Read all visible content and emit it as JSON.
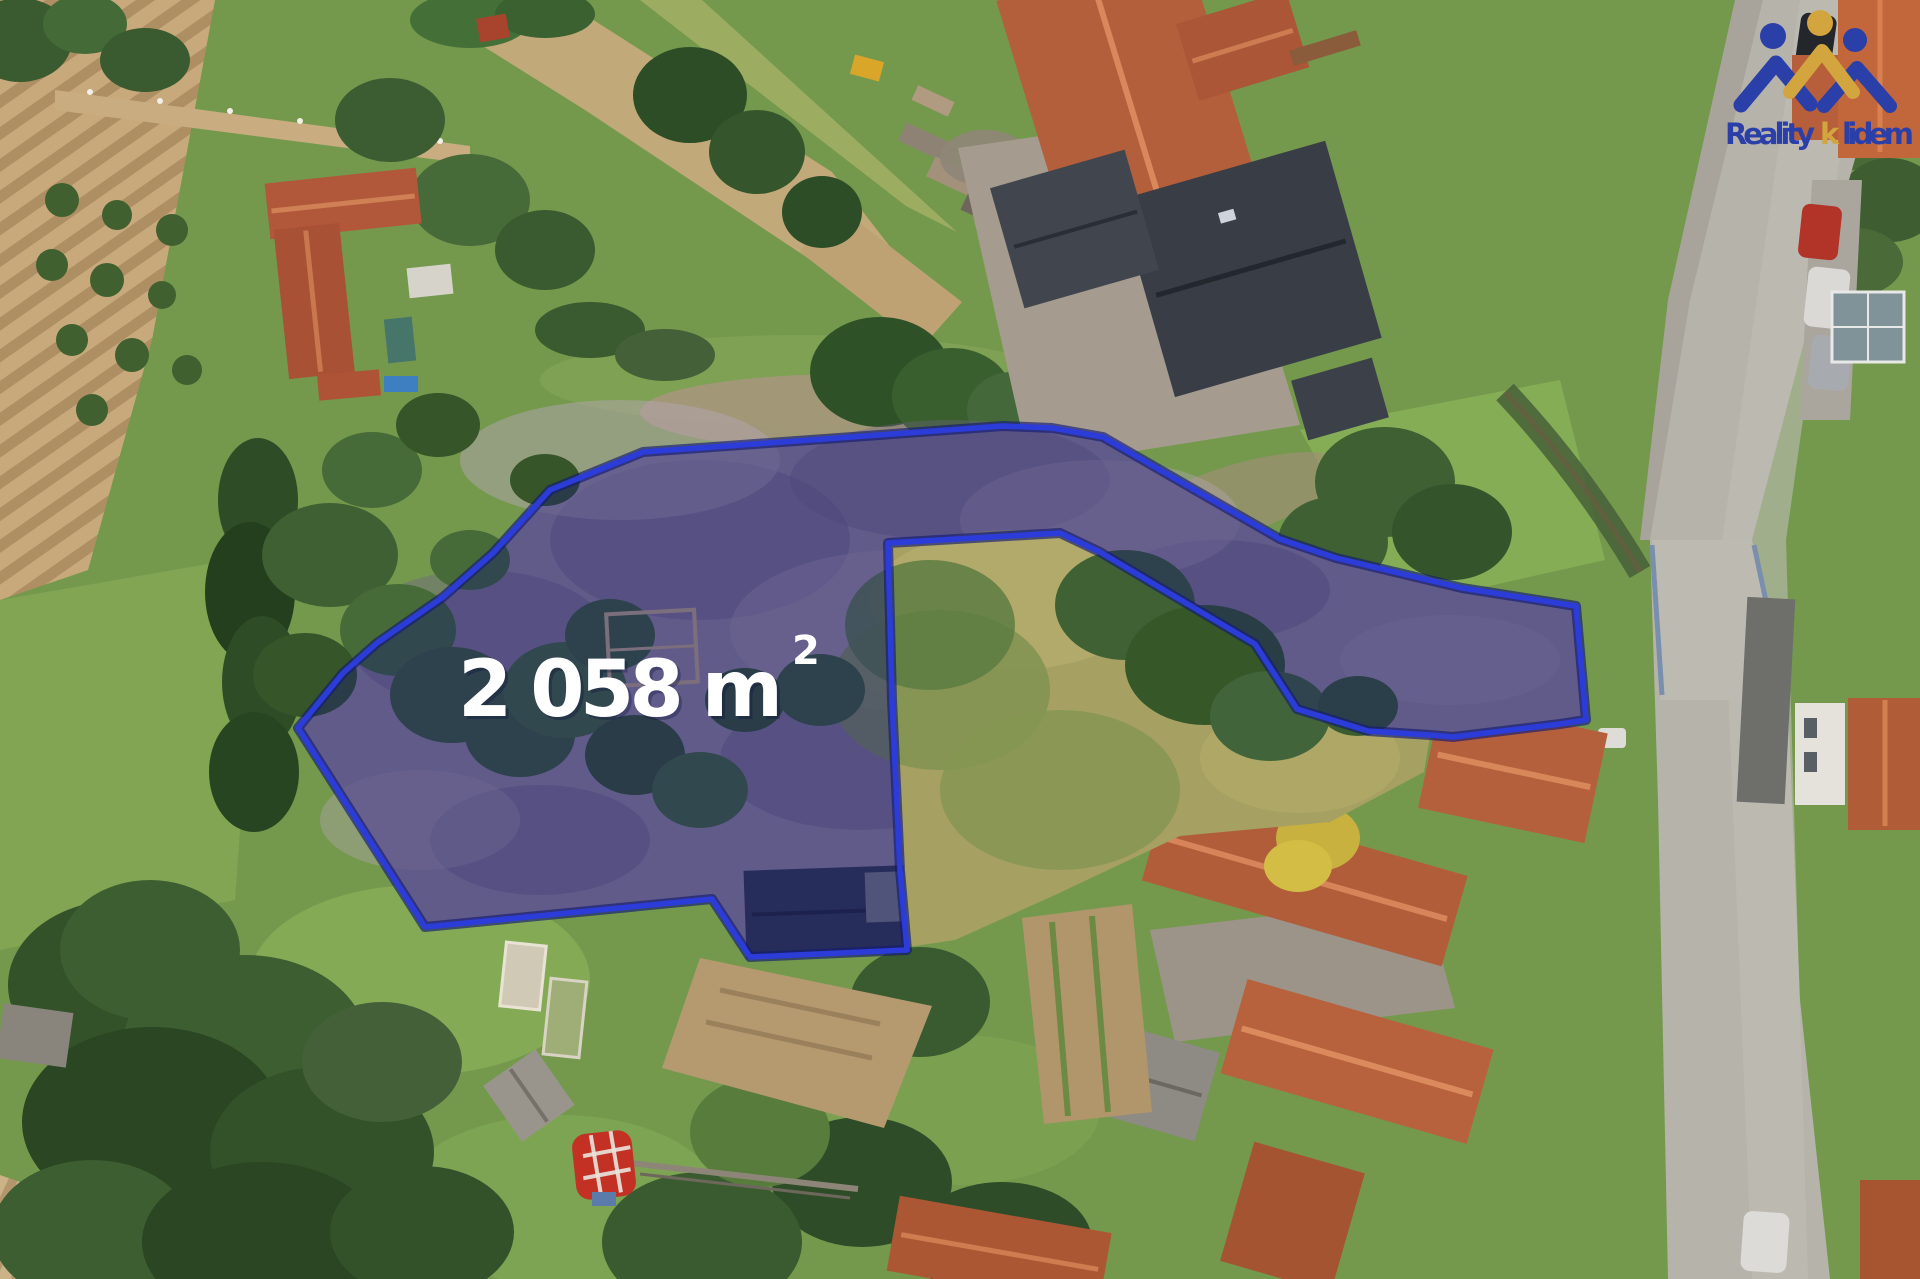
{
  "meta": {
    "type": "aerial-drone-photo",
    "description": "Top-down drone photo of a village building plot for sale, plot outlined in blue with translucent navy shading, area label and agency logo"
  },
  "area_badge": {
    "text": "2 058 m",
    "superscript": "2",
    "full": "2 058 m²",
    "color": "#ffffff"
  },
  "boundary": {
    "stroke": "#2b3cd8",
    "glow": "#141b72",
    "fill_rgba": "rgba(24,28,110,0.44)",
    "path_d": "M643,452 L755,444 L1003,426 L1052,428 L1103,437 L1280,539 L1336,558 L1462,588 L1576,606 L1586,720 L1560,724 L1453,737 L1430,735 L1368,731 L1297,709 L1255,644 L1100,552 L1060,533 L888,543 L892,700 L900,870 L907,950 L750,957 L712,899 L425,927 L298,728 L343,673 L377,643 L443,597 L493,553 L550,490 Z"
  },
  "logo": {
    "word1": "Reality",
    "accent": "k",
    "word2": "lidem",
    "blue": "#2b3fa8",
    "gold": "#d2a53f"
  }
}
